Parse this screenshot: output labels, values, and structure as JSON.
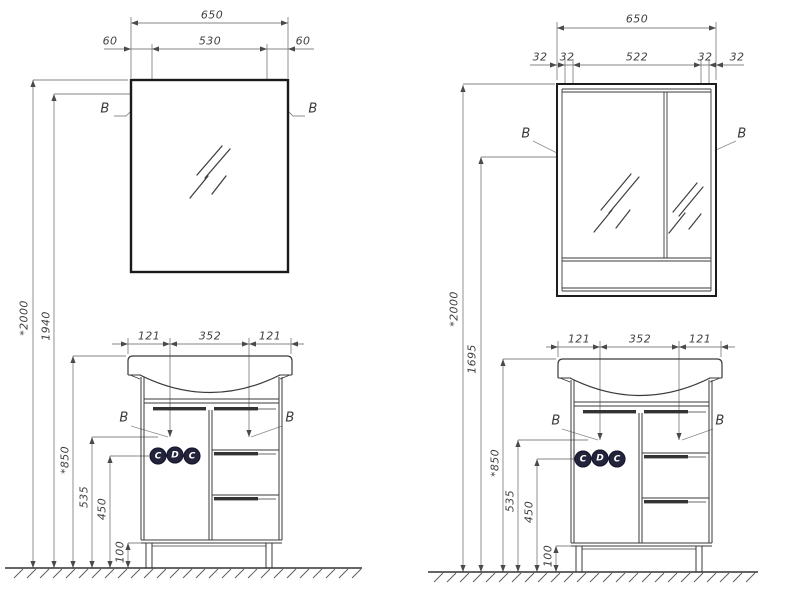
{
  "page": {
    "background": "#ffffff",
    "line_color": "#3a3a3a",
    "dim_line_color": "#828282",
    "badge_color": "#23233c"
  },
  "left_drawing": {
    "mirror": {
      "width_total": "650",
      "offset_left": "60",
      "glass_width": "530",
      "offset_right": "60",
      "height_wall": "*2000",
      "height_mount": "1940",
      "detail_left": "B",
      "detail_right": "B"
    },
    "vanity": {
      "width_left": "121",
      "width_basin": "352",
      "width_right": "121",
      "height_total": "*850",
      "height_mid": "535",
      "height_low": "450",
      "height_plinth": "100",
      "detail_left": "B",
      "detail_right": "B",
      "badges": [
        "C",
        "D",
        "C"
      ]
    }
  },
  "right_drawing": {
    "mirror_cabinet": {
      "width_total": "650",
      "offset_outer_left": "32",
      "offset_inner_left": "32",
      "door_width": "522",
      "offset_inner_right": "32",
      "offset_outer_right": "32",
      "height_wall": "*2000",
      "height_mount": "1695",
      "detail_left": "B",
      "detail_right": "B"
    },
    "vanity": {
      "width_left": "121",
      "width_basin": "352",
      "width_right": "121",
      "height_total": "*850",
      "height_mid": "535",
      "height_low": "450",
      "height_plinth": "100",
      "detail_left": "B",
      "detail_right": "B",
      "badges": [
        "C",
        "D",
        "C"
      ]
    }
  }
}
